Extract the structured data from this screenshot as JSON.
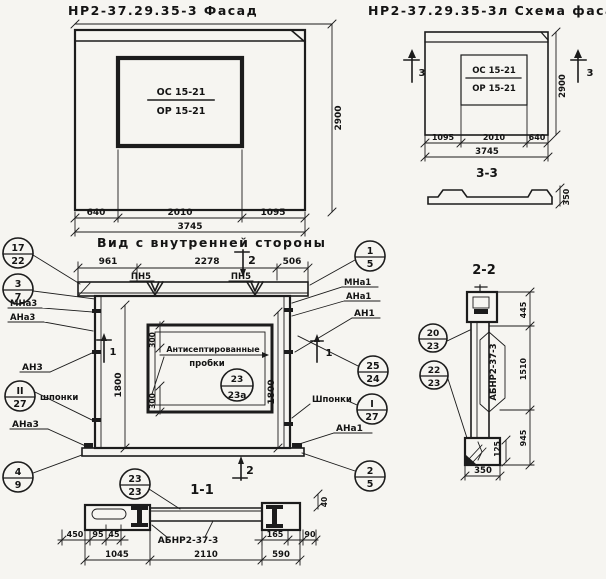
{
  "facade": {
    "title": "НР2-37.29.35-3 Фасад",
    "window_mark_top": "ОС 15-21",
    "window_mark_bottom": "ОР 15-21",
    "dim_left": "640",
    "dim_mid": "2010",
    "dim_right": "1095",
    "dim_total": "3745",
    "dim_height": "2900"
  },
  "scheme": {
    "title": "НР2-37.29.35-3л Схема фасада",
    "window_mark_top": "ОС 15-21",
    "window_mark_bottom": "ОР 15-21",
    "dim_left": "1095",
    "dim_mid": "2010",
    "dim_right": "640",
    "dim_total": "3745",
    "dim_height": "2900",
    "section_mark": "3",
    "section_title": "3-3",
    "profile_thickness": "350"
  },
  "inner": {
    "title": "Вид с внутренней стороны",
    "dim_top_left": "961",
    "dim_top_mid": "2278",
    "dim_top_right": "506",
    "loop_label": "ПН5",
    "dim_side": "1800",
    "dim_window_offset": "300",
    "plugs_label_1": "Антисептированные",
    "plugs_label_2": "пробки",
    "keys_label_left": "шпонки",
    "keys_label_right": "Шпонки",
    "section_mark_1": "1",
    "section_mark_2": "2",
    "anchor_mna3": "МНа3",
    "anchor_ana3": "АНа3",
    "anchor_an3": "АН3",
    "anchor_ana3_bottom": "АНа3",
    "anchor_mna1": "МНа1",
    "anchor_ana1": "АНа1",
    "anchor_an1": "АН1",
    "anchor_ana1_bottom": "АНа1",
    "callout_17_22": {
      "top": "17",
      "bottom": "22"
    },
    "callout_3_7": {
      "top": "3",
      "bottom": "7"
    },
    "callout_11_27": {
      "top": "II",
      "bottom": "27"
    },
    "callout_4_9": {
      "top": "4",
      "bottom": "9"
    },
    "callout_1_5": {
      "top": "1",
      "bottom": "5"
    },
    "callout_25_24": {
      "top": "25",
      "bottom": "24"
    },
    "callout_I_27": {
      "top": "I",
      "bottom": "27"
    },
    "callout_2_5": {
      "top": "2",
      "bottom": "5"
    },
    "callout_23_23a": {
      "top": "23",
      "bottom": "23а"
    }
  },
  "section11": {
    "title": "1-1",
    "callout_23_23": {
      "top": "23",
      "bottom": "23"
    },
    "beam_mark": "АБНР2-37-3",
    "dim_450": "450",
    "dim_95": "95",
    "dim_45": "45",
    "dim_165": "165",
    "dim_90": "90",
    "dim_40": "40",
    "dim_1045": "1045",
    "dim_2110": "2110",
    "dim_590": "590"
  },
  "section22": {
    "title": "2-2",
    "beam_mark": "АБНР2-37-3",
    "callout_20_23": {
      "top": "20",
      "bottom": "23"
    },
    "callout_22_23": {
      "top": "22",
      "bottom": "23"
    },
    "dim_445": "445",
    "dim_1510": "1510",
    "dim_945": "945",
    "dim_125": "125",
    "dim_350": "350"
  }
}
